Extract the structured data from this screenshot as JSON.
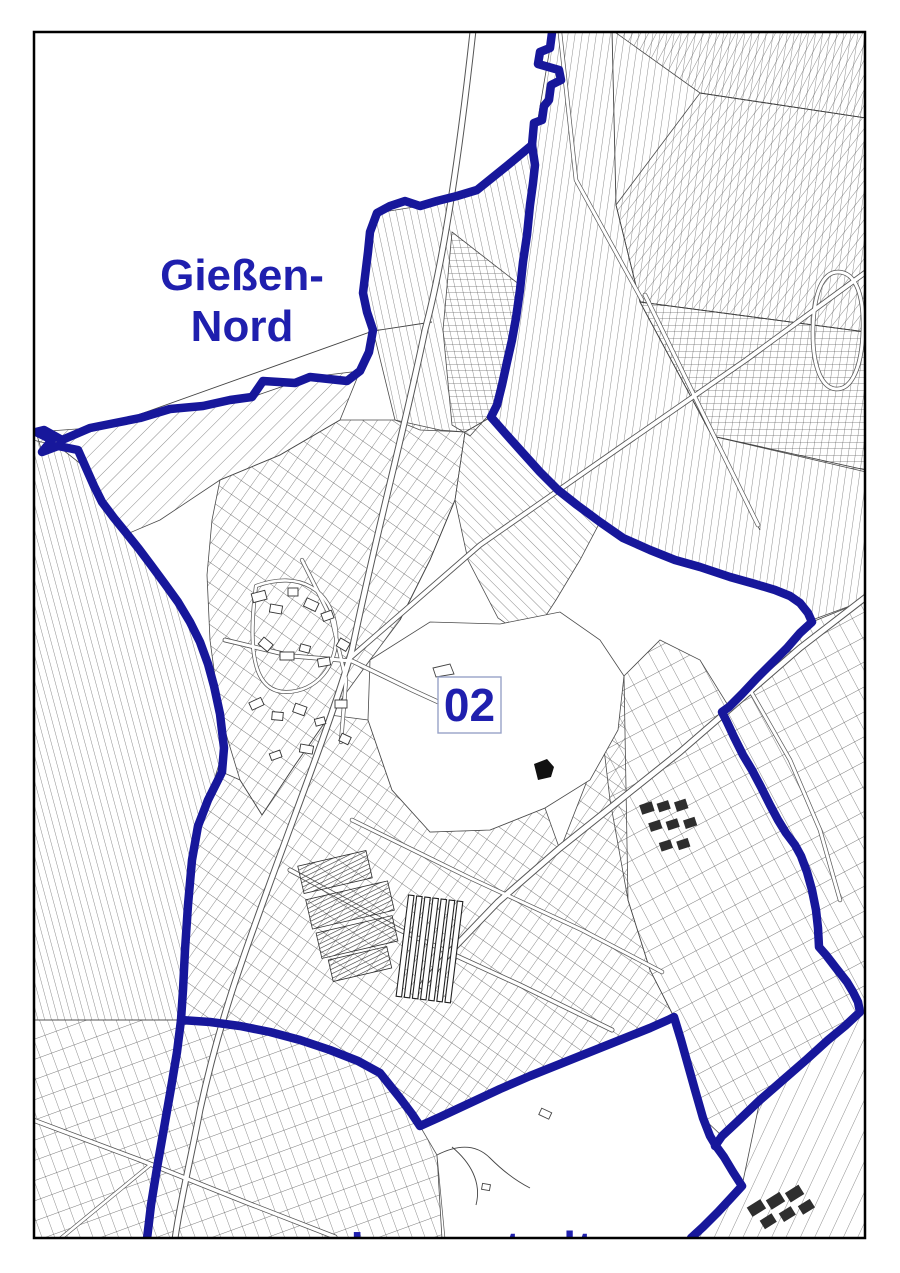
{
  "map": {
    "title": "Gießen city district map",
    "labels": {
      "north_district": "Gießen-Nord",
      "north_district_line1": "Gießen-",
      "north_district_line2": "Nord",
      "district_number": "02",
      "south_district_clipped": "Innenstadt"
    },
    "colors": {
      "boundary": "#17179b",
      "label": "#1f1fae",
      "number_box_border": "#98a2c8",
      "parcel_line": "#4f4f4f",
      "frame": "#000000",
      "background": "#ffffff"
    }
  }
}
